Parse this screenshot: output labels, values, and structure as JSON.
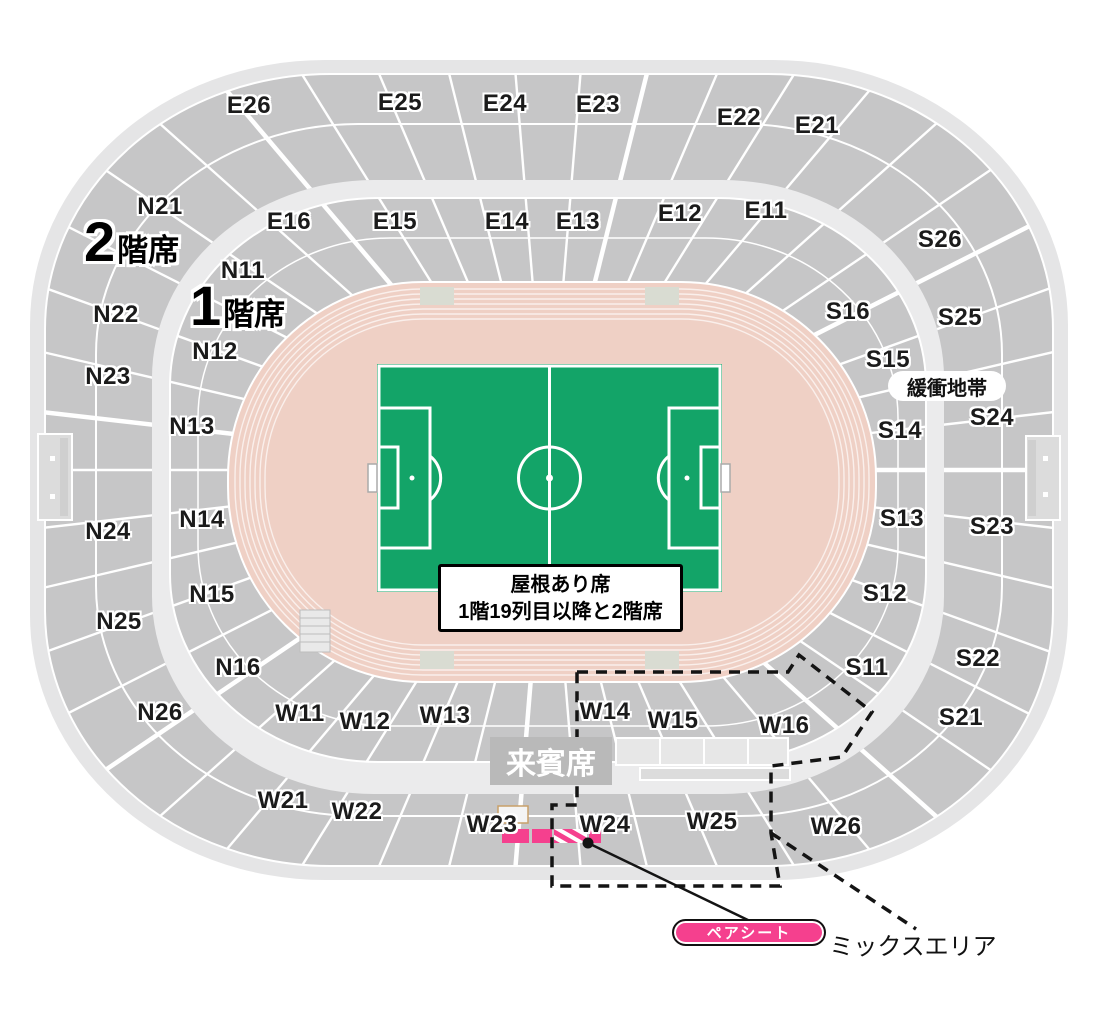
{
  "map": {
    "floors": [
      {
        "id": "floor-2",
        "big": "2",
        "small": "階席",
        "x": 84,
        "y": 214
      },
      {
        "id": "floor-1",
        "big": "1",
        "small": "階席",
        "x": 190,
        "y": 278
      }
    ],
    "sections": [
      {
        "id": "E26",
        "x": 249,
        "y": 106
      },
      {
        "id": "E25",
        "x": 400,
        "y": 103
      },
      {
        "id": "E24",
        "x": 505,
        "y": 104
      },
      {
        "id": "E23",
        "x": 598,
        "y": 105
      },
      {
        "id": "E22",
        "x": 739,
        "y": 118
      },
      {
        "id": "E21",
        "x": 817,
        "y": 126
      },
      {
        "id": "E16",
        "x": 289,
        "y": 222
      },
      {
        "id": "E15",
        "x": 395,
        "y": 222
      },
      {
        "id": "E14",
        "x": 507,
        "y": 222
      },
      {
        "id": "E13",
        "x": 578,
        "y": 222
      },
      {
        "id": "E12",
        "x": 680,
        "y": 214
      },
      {
        "id": "E11",
        "x": 766,
        "y": 211
      },
      {
        "id": "N21",
        "x": 160,
        "y": 207
      },
      {
        "id": "N22",
        "x": 116,
        "y": 315
      },
      {
        "id": "N23",
        "x": 108,
        "y": 377
      },
      {
        "id": "N24",
        "x": 108,
        "y": 532
      },
      {
        "id": "N25",
        "x": 119,
        "y": 622
      },
      {
        "id": "N26",
        "x": 160,
        "y": 713
      },
      {
        "id": "N11",
        "x": 243,
        "y": 271
      },
      {
        "id": "N12",
        "x": 215,
        "y": 352
      },
      {
        "id": "N13",
        "x": 192,
        "y": 427
      },
      {
        "id": "N14",
        "x": 202,
        "y": 520
      },
      {
        "id": "N15",
        "x": 212,
        "y": 595
      },
      {
        "id": "N16",
        "x": 238,
        "y": 668
      },
      {
        "id": "S26",
        "x": 940,
        "y": 240
      },
      {
        "id": "S25",
        "x": 960,
        "y": 318
      },
      {
        "id": "S24",
        "x": 992,
        "y": 418
      },
      {
        "id": "S23",
        "x": 992,
        "y": 527
      },
      {
        "id": "S22",
        "x": 978,
        "y": 659
      },
      {
        "id": "S21",
        "x": 961,
        "y": 718
      },
      {
        "id": "S16",
        "x": 848,
        "y": 312
      },
      {
        "id": "S15",
        "x": 888,
        "y": 360
      },
      {
        "id": "S14",
        "x": 900,
        "y": 431
      },
      {
        "id": "S13",
        "x": 902,
        "y": 519
      },
      {
        "id": "S12",
        "x": 885,
        "y": 594
      },
      {
        "id": "S11",
        "x": 867,
        "y": 668
      },
      {
        "id": "W11",
        "x": 300,
        "y": 714
      },
      {
        "id": "W12",
        "x": 365,
        "y": 722
      },
      {
        "id": "W13",
        "x": 445,
        "y": 716
      },
      {
        "id": "W14",
        "x": 605,
        "y": 712
      },
      {
        "id": "W15",
        "x": 673,
        "y": 721
      },
      {
        "id": "W16",
        "x": 784,
        "y": 726
      },
      {
        "id": "W21",
        "x": 283,
        "y": 801
      },
      {
        "id": "W22",
        "x": 357,
        "y": 812
      },
      {
        "id": "W23",
        "x": 492,
        "y": 825
      },
      {
        "id": "W24",
        "x": 605,
        "y": 825
      },
      {
        "id": "W25",
        "x": 712,
        "y": 822
      },
      {
        "id": "W26",
        "x": 836,
        "y": 827
      }
    ],
    "callouts": {
      "buffer_zone": {
        "text": "緩衝地帯"
      },
      "vip_seats": {
        "text": "来賓席"
      },
      "roof_note": {
        "line1": "屋根あり席",
        "line2": "1階19列目以降と2階席"
      },
      "pair_seat": {
        "text": "ペアシート"
      },
      "mix_area": {
        "text": "ミックスエリア"
      }
    },
    "colors": {
      "seats": "#c6c6c7",
      "rim": "#e5e5e6",
      "concourse": "#ebebec",
      "track": "#efd0c5",
      "field": "#13a468",
      "highlight_pink": "#f5408e",
      "vip_box_gray": "#b9b9b9"
    }
  }
}
